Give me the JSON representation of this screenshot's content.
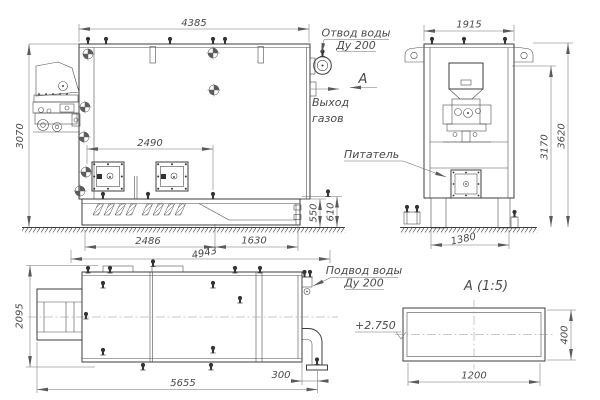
{
  "views": {
    "front": {
      "dims": {
        "width": "4385",
        "height": "3070",
        "doors_span": "2490",
        "base_left": "2486",
        "base_total": "4943",
        "base_right": "1630",
        "base_height": "550",
        "inlet_height": "610"
      },
      "callouts": {
        "water_outlet_line1": "Отвод воды",
        "water_outlet_line2": "Ду 200",
        "gas_exit_line1": "Выход",
        "gas_exit_line2": "газов",
        "section_letter": "А"
      }
    },
    "side": {
      "dims": {
        "width": "1915",
        "chamber_height": "3170",
        "total_height": "3620",
        "base_width": "1380"
      },
      "callouts": {
        "feeder": "Питатель"
      }
    },
    "plan": {
      "dims": {
        "depth": "2095",
        "total_length": "5655",
        "pipe_offset": "300"
      },
      "callouts": {
        "water_inlet_line1": "Подвод воды",
        "water_inlet_line2": "Ду 200"
      }
    },
    "section_a": {
      "title": "А  (1:5)",
      "dims": {
        "duct_width": "1200",
        "duct_height": "400"
      },
      "elevation_mark": "+2.750"
    }
  }
}
